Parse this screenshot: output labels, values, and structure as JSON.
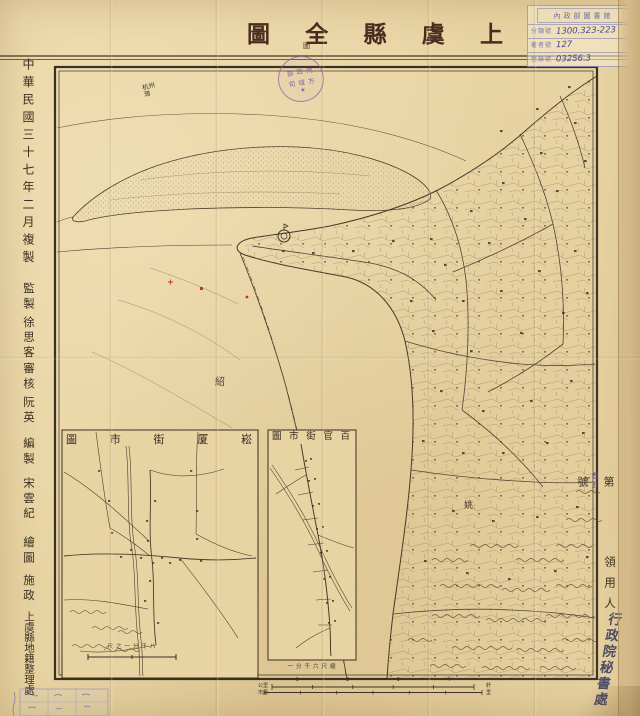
{
  "colors": {
    "paper": "#e8d3a2",
    "ink": "#3e3226",
    "title_ink": "#4a2c1f",
    "stamp_purple": "#8a63ae",
    "hand_blue": "#42469a",
    "accent_red": "#b43a2c"
  },
  "title": {
    "text": "上虞縣全圖",
    "seal_mark": "圖"
  },
  "library_label": {
    "header": "內政部圖書館",
    "rows": [
      {
        "label": "分類號",
        "value": "1300.323-223"
      },
      {
        "label": "著者號",
        "value": "127"
      },
      {
        "label": "登錄號",
        "value": "03256.3"
      }
    ]
  },
  "left_margin": {
    "groups": [
      "中華民國三十七年二月複製",
      "監製",
      "徐思客",
      "審核",
      "阮英",
      "編製",
      "宋雲紀",
      "繪圖",
      "施政",
      "上虞縣地籍整理處"
    ]
  },
  "right_margin": {
    "serial_prefix": "第",
    "serial_hand": "叁五",
    "serial_suffix": "號",
    "holder_label": "領用人",
    "holder_value": "行政院秘書處"
  },
  "stamp": {
    "line1": "內政部",
    "line2": "方域司",
    "star": "★"
  },
  "map": {
    "bay_label": "杭州灣",
    "boundary_label_west": "紹",
    "boundary_label_east": "姚"
  },
  "insets": {
    "songxia": {
      "title": "崧厦街市圖",
      "scale_note": "八千分一之尺"
    },
    "baiguan": {
      "title": "百官街市圖",
      "scale_note": "縮尺六千分一"
    }
  },
  "scale_bar": {
    "numbers": [
      "1",
      "2",
      "3",
      "4"
    ],
    "left_top": "公里",
    "left_bottom": "市里",
    "right_top": "粁",
    "right_bottom": "里"
  }
}
